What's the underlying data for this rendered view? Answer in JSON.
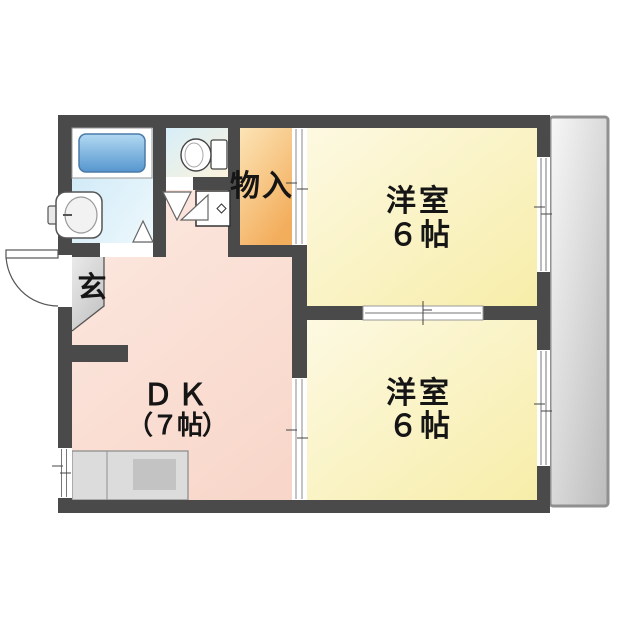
{
  "plan": {
    "type": "apartment-floorplan-2DK",
    "rooms": {
      "storage": {
        "label": "物入"
      },
      "entrance": {
        "label": "玄"
      },
      "dk": {
        "name": "ＤＫ",
        "size": "（７帖）"
      },
      "room_top": {
        "name": "洋室",
        "size": "６帖"
      },
      "room_bottom": {
        "name": "洋室",
        "size": "６帖"
      }
    },
    "fixtures": {
      "bathtub": "bathtub",
      "wash_basin": "wash-basin",
      "toilet": "toilet",
      "washing_machine_space": "washing-machine-space",
      "kitchen_counter": "kitchen-counter-with-sink",
      "entrance_door": "hinged-entrance-door",
      "balcony": "balcony"
    },
    "colors": {
      "wall": "#4a4a4a",
      "room_yellow": "#f7eda9",
      "dk_pink": "#f6cdbd",
      "storage_orange": "#f3ae5d",
      "bath_blue": "#c9e7f7",
      "tub_blue": "#5596cf",
      "balcony_gray": "#bcbcbc",
      "entrance_gray": "#c4c4c4",
      "text": "#151515"
    }
  }
}
